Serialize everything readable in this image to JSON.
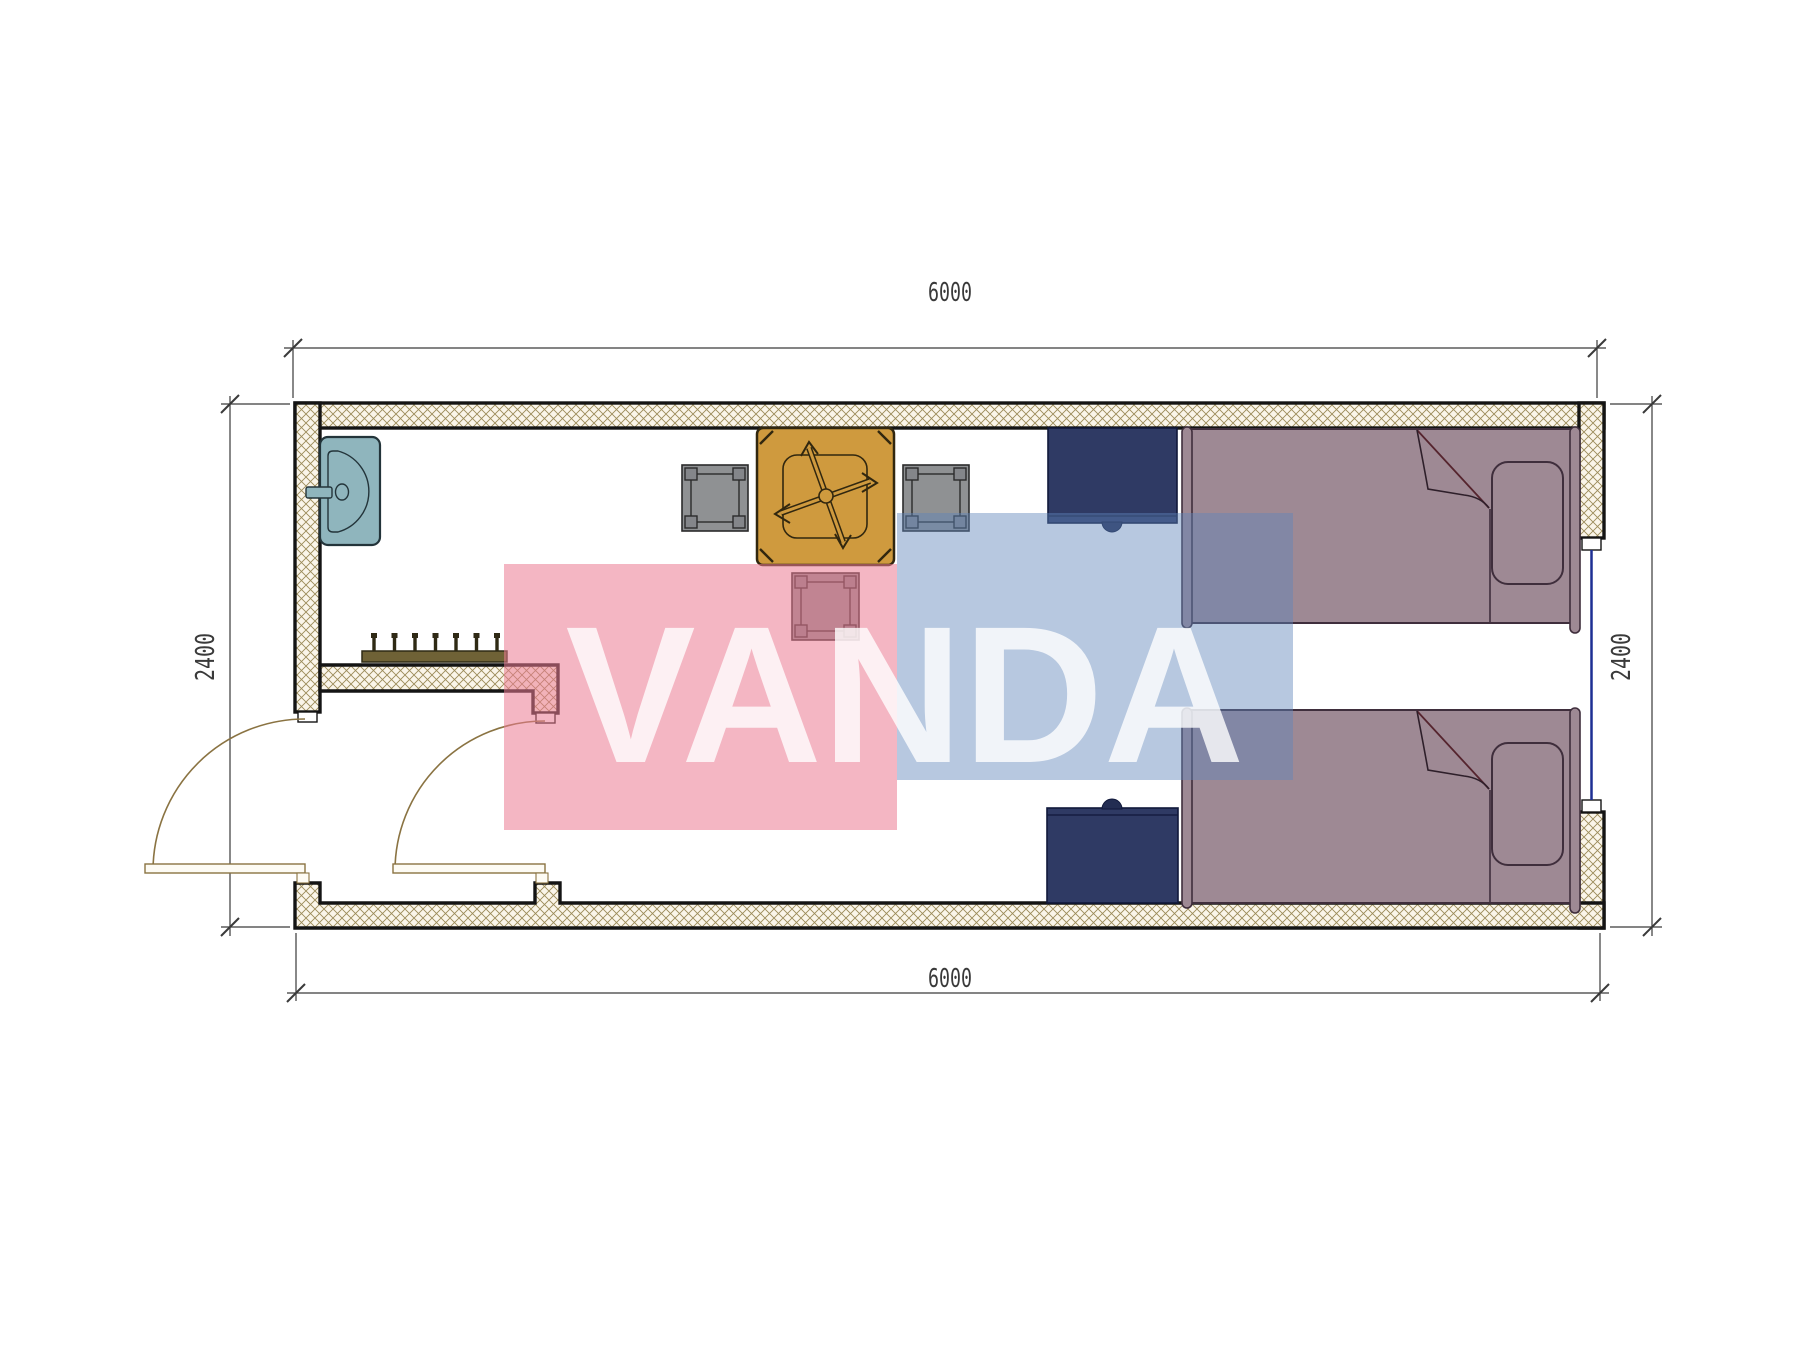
{
  "title": "container-room-floor-plan",
  "dimensions": {
    "top": "6000",
    "bottom": "6000",
    "left": "2400",
    "right": "2400"
  },
  "watermark": {
    "text": "VANDA",
    "pink_color": "rgba(235,122,146,0.55)",
    "blue_color": "rgba(95,133,187,0.45)",
    "text_color": "rgba(255,255,255,0.80)"
  },
  "palette": {
    "wall_hatch_line": "#9b8b58",
    "wall_hatch_bg": "#faf5e9",
    "wall_outline": "#141414",
    "dim_line": "#3a3a3a",
    "sink": "#8fb5bd",
    "sink_outline": "#23343a",
    "table": "#cf9a3e",
    "table_outline": "#31270f",
    "chair": "#8f9193",
    "chair_post": "#84868a",
    "chair_outline": "#2b2b2b",
    "nightstand": "#2f3a64",
    "nightstand_outline": "#10183a",
    "nightstand_knob": "#232d52",
    "bed": "#9e8994",
    "bed_outline": "#3f2e3c",
    "window_glass": "#1d2f93",
    "door": "#8a7342",
    "door_leaf_fill": "#fdfbf4",
    "coat_rack": "#6f6236",
    "coat_rack_outline": "#2f2a15"
  },
  "furniture": [
    {
      "name": "sink"
    },
    {
      "name": "coat-rack"
    },
    {
      "name": "dining-table"
    },
    {
      "name": "chair-left"
    },
    {
      "name": "chair-right"
    },
    {
      "name": "chair-bottom"
    },
    {
      "name": "nightstand-top"
    },
    {
      "name": "nightstand-bottom"
    },
    {
      "name": "bed-top"
    },
    {
      "name": "bed-bottom"
    },
    {
      "name": "exterior-door"
    },
    {
      "name": "interior-door"
    },
    {
      "name": "window-right"
    }
  ]
}
